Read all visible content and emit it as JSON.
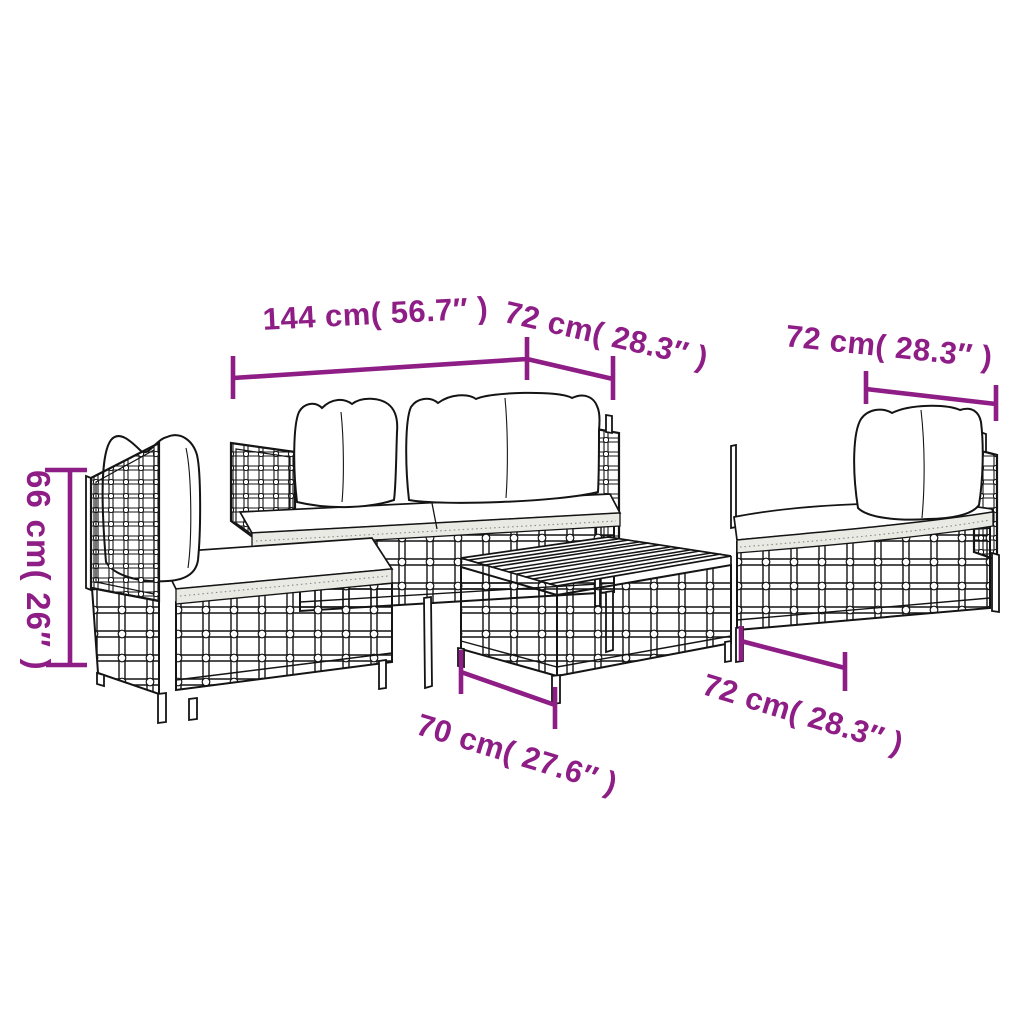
{
  "diagram": {
    "type": "product-dimension-diagram",
    "subject": "5-piece rattan garden lounge set line drawing",
    "colors": {
      "accent": "#8E1D86",
      "line_art": "#141414",
      "cushion_shade": "#EAEAE5",
      "background": "#FFFFFF"
    },
    "dimensions": {
      "sofa_width_top": {
        "label": "144 cm( 56.7″ )"
      },
      "section_depth_top_middle": {
        "label": "72 cm( 28.3″ )"
      },
      "armchair_width_top_right": {
        "label": "72 cm( 28.3″ )"
      },
      "back_height_left": {
        "label": "66 cm( 26″ )"
      },
      "table_width_bottom": {
        "label": "70 cm( 27.6″ )"
      },
      "section_depth_bottom_right": {
        "label": "72 cm( 28.3″ )"
      }
    }
  }
}
